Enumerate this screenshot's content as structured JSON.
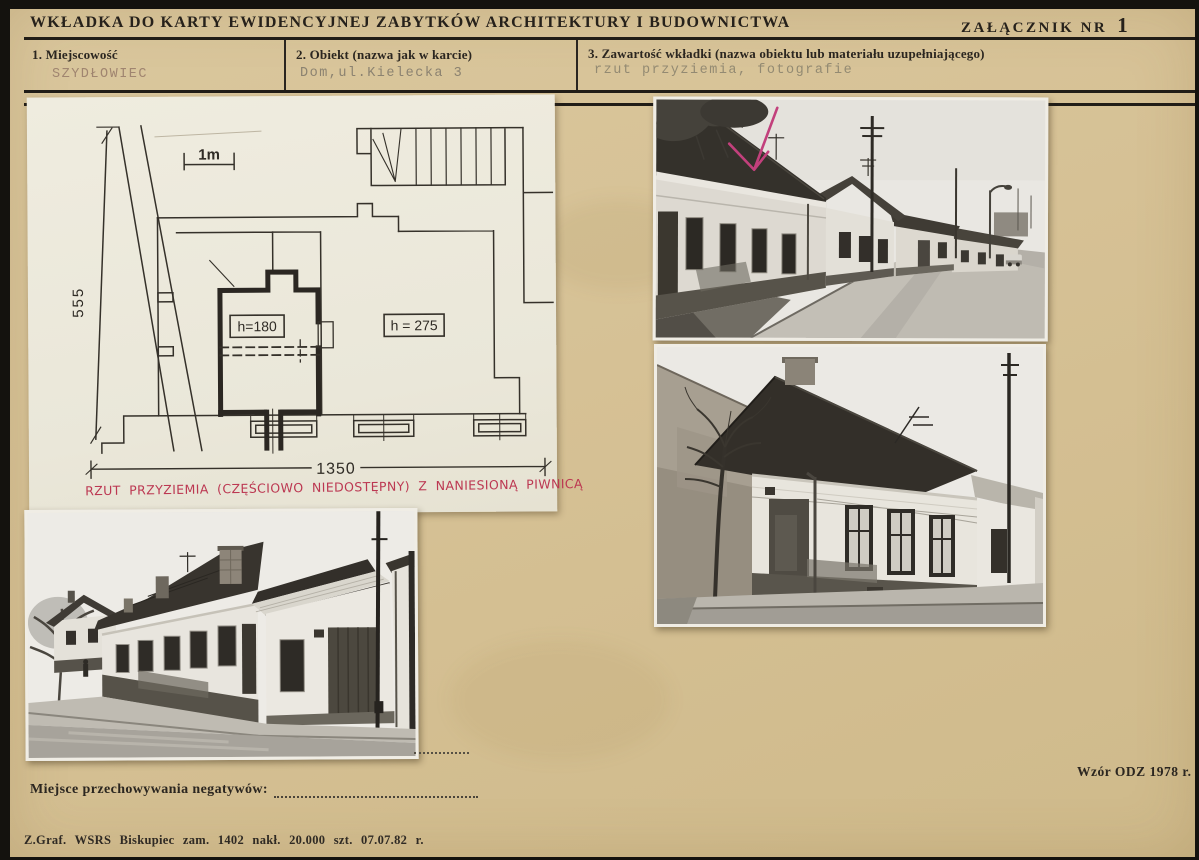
{
  "document": {
    "title": "WKŁADKA DO KARTY EWIDENCYJNEJ ZABYTKÓW ARCHITEKTURY I BUDOWNICTWA",
    "attachment_label": "ZAŁĄCZNIK NR",
    "attachment_number": "1"
  },
  "fields": {
    "locality": {
      "label": "1. Miejscowość",
      "value": "SZYDŁOWIEC"
    },
    "object": {
      "label": "2. Obiekt (nazwa jak w karcie)",
      "value": "Dom,ul.Kielecka 3"
    },
    "contents": {
      "label": "3. Zawartość wkładki (nazwa obiektu lub materiału uzupełniającego)",
      "value": "rzut przyziemia, fotografie"
    }
  },
  "plan": {
    "scale_label": "1m",
    "dim_width": "1350",
    "dim_height": "555",
    "room_height_left": "h=180",
    "room_height_right": "h = 275",
    "caption": "RZUT PRZYZIEMIA (CZĘŚCIOWO NIEDOSTĘPNY) Z NANIESIONĄ PIWNICĄ"
  },
  "footer": {
    "negatives_label": "Miejsce przechowywania negatywów:",
    "pattern_note": "Wzór ODZ 1978 r.",
    "print_note": "Z.Graf. WSRS Biskupiec zam. 1402 nakł. 20.000 szt. 07.07.82 r."
  },
  "colors": {
    "card": "#d6c195",
    "plan_paper": "#edeadd",
    "ink": "#2b2620",
    "typewriter_faded": "#938a72",
    "annotation_red": "#bc3852",
    "arrow_pink": "#c2407c"
  }
}
